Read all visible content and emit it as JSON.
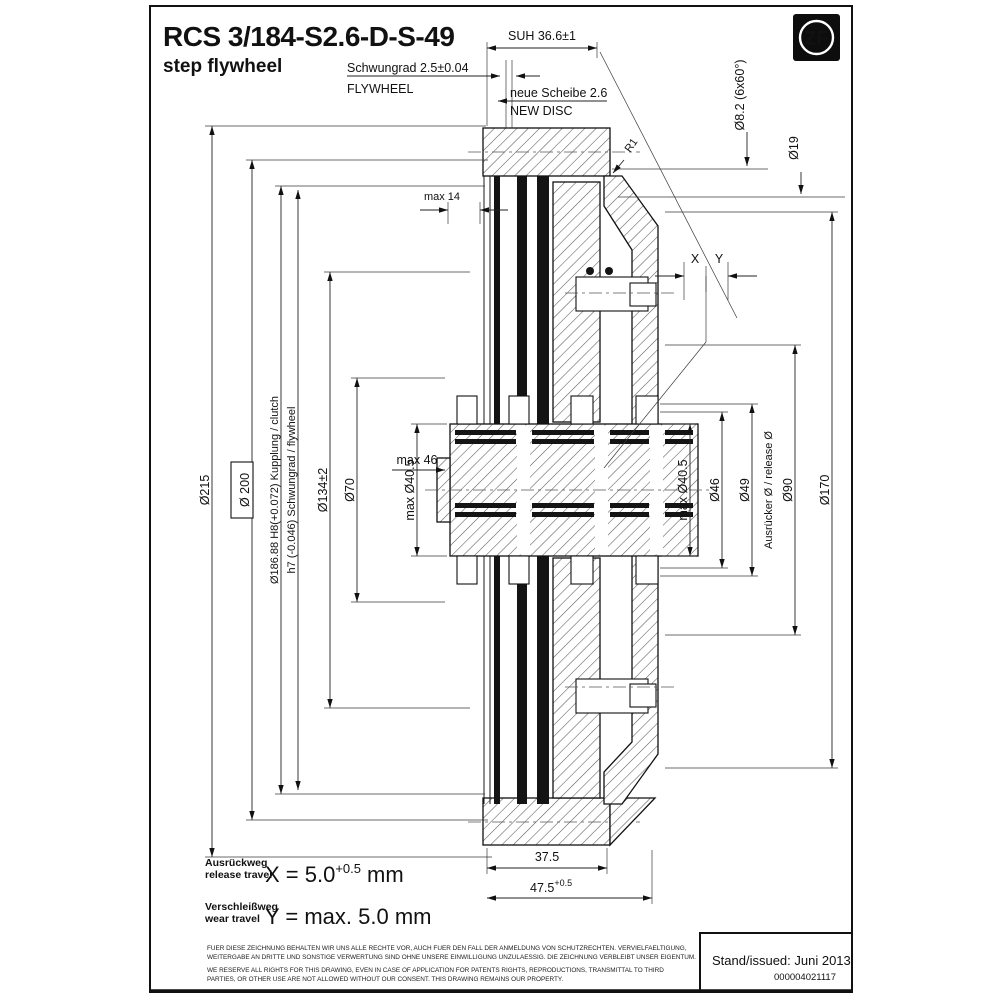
{
  "header": {
    "part_number": "RCS 3/184-S2.6-D-S-49",
    "subtitle": "step flywheel",
    "logo_text": "ZF"
  },
  "top_annotations": {
    "suh": "SUH 36.6±1",
    "flywheel_de": "Schwungrad 2.5±0.04",
    "flywheel_en": "FLYWHEEL",
    "new_disc_de": "neue Scheibe 2.6",
    "new_disc_en": "NEW DISC",
    "bolt_circle": "Ø8.2 (6x60°)",
    "d19": "Ø19",
    "r1": "R1",
    "max14": "max 14",
    "x": "X",
    "y": "Y"
  },
  "dims_left": {
    "d215": "Ø215",
    "d200": "Ø 200",
    "d18688": "Ø186.88 H8(+0.072)  Kupplung / clutch",
    "h7": "h7 (-0.046)  Schwungrad / flywheel",
    "d134": "Ø134±2",
    "d70": "Ø70",
    "dmax405": "max Ø40.5",
    "max46": "max 46"
  },
  "dims_right": {
    "dmax405": "max Ø40.5",
    "d46": "Ø46",
    "d49": "Ø49",
    "release": "Ausrücker Ø / release Ø",
    "d90": "Ø90",
    "d170": "Ø170"
  },
  "dims_bottom": {
    "w1": "37.5",
    "w2": "47.5",
    "w2_sup": "+0.5"
  },
  "travel": {
    "release_de": "Ausrückweg",
    "release_en": "release travel",
    "x_eq": "X = 5.0",
    "x_sup": "+0.5",
    "x_unit": "mm",
    "wear_de": "Verschleißweg",
    "wear_en": "wear travel",
    "y_eq": "Y = max. 5.0 mm"
  },
  "legal": {
    "de1": "FUER DIESE ZEICHNUNG BEHALTEN WIR UNS ALLE RECHTE VOR, AUCH FUER DEN FALL DER ANMELDUNG VON SCHUTZRECHTEN. VERVIELFAELTIGUNG,",
    "de2": "WEITERGABE AN DRITTE UND SONSTIGE VERWERTUNG SIND OHNE UNSERE EINWILLIGUNG UNZULAESSIG. DIE ZEICHNUNG VERBLEIBT UNSER EIGENTUM.",
    "en1": "WE RESERVE ALL RIGHTS FOR THIS DRAWING, EVEN IN CASE OF APPLICATION FOR PATENTS RIGHTS, REPRODUCTIONS, TRANSMITTAL TO THIRD",
    "en2": "PARTIES, OR OTHER USE ARE NOT ALLOWED WITHOUT OUR CONSENT. THIS DRAWING REMAINS OUR PROPERTY."
  },
  "title_block": {
    "issued": "Stand/issued: Juni 2013",
    "doc_number": "000004021117"
  }
}
